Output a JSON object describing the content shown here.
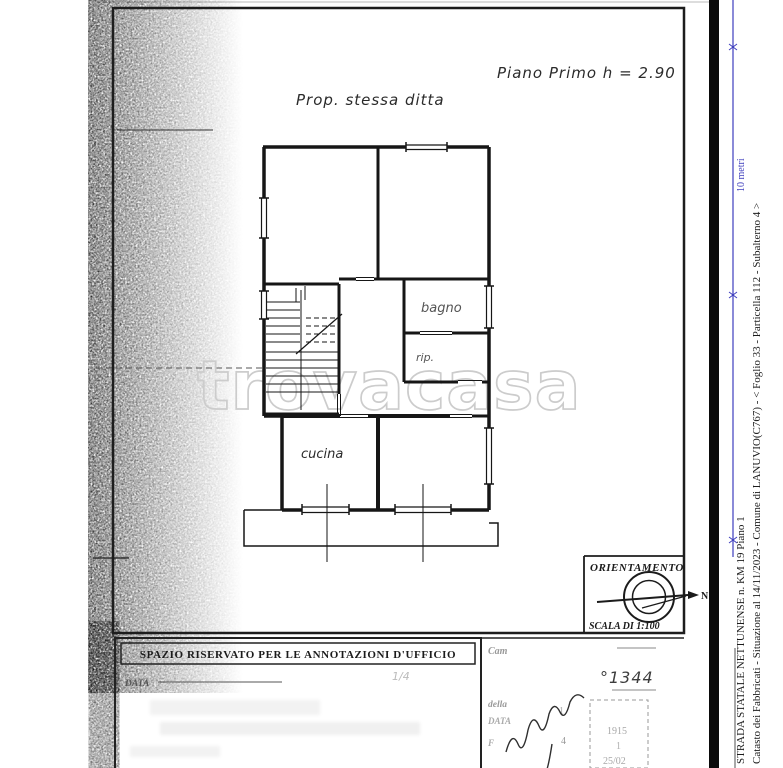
{
  "document": {
    "watermark": "trovacasa",
    "notes": {
      "property": "Prop. stessa ditta",
      "floor": "Piano Primo h = 2.90"
    },
    "rooms": {
      "bathroom": "bagno",
      "closet": "rip.",
      "kitchen": "cucina"
    },
    "orientation": {
      "title": "ORIENTAMENTO",
      "north": "N",
      "scale": "SCALA DI 1:100"
    },
    "scale_bar": {
      "label": "10 metri"
    },
    "office_box": {
      "title": "SPAZIO RISERVATO PER LE ANNOTAZIONI D'UFFICIO",
      "date_label": "DATA",
      "date_note": "1/4"
    },
    "right_section": {
      "line1": "Cam",
      "line2": "della",
      "line3": "DATA",
      "line4": "F",
      "protocol_number": "°1344",
      "mark1": "1",
      "mark2": "4",
      "stamp": {
        "line1": "1915",
        "line2": "1",
        "line3": "25/02"
      }
    },
    "margin": {
      "line1": "Catasto dei Fabbricati - Situazione al 14/11/2023 - Comune di LANUVIO(C767) - <  Foglio 33 - Particella 112 - Subalterno 4 >",
      "line2": "STRADA STATALE NETTUNENSE n. KM 19 Piano 1"
    }
  },
  "colors": {
    "ink": "#1b1b1b",
    "scale_blue": "#3e3ebd",
    "watermark_grey": "#cccccc",
    "faint_grey": "#9a9a9a",
    "page_edge_black": "#0b0b0b"
  }
}
